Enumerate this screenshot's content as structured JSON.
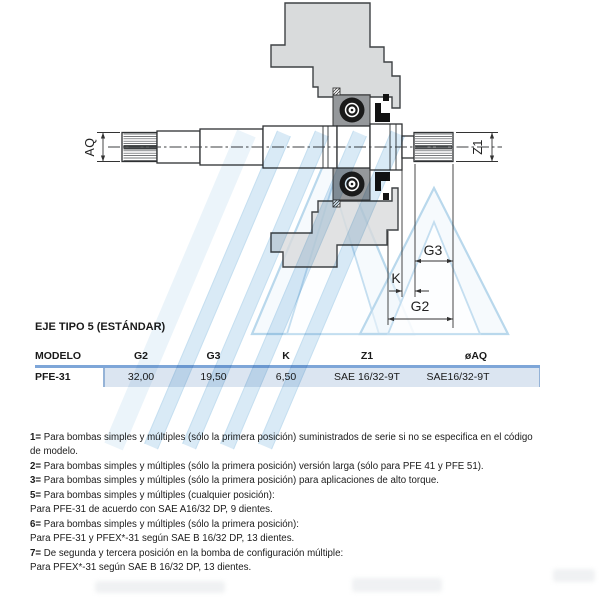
{
  "drawing": {
    "labels": {
      "aq": "AQ",
      "z1": "Z1",
      "g3": "G3",
      "k": "K",
      "g2": "G2"
    }
  },
  "table": {
    "title": "EJE TIPO 5 (ESTÁNDAR)",
    "headers": [
      "MODELO",
      "G2",
      "G3",
      "K",
      "Z1",
      "øAQ"
    ],
    "row": {
      "modelo": "PFE-31",
      "g2": "32,00",
      "g3": "19,50",
      "k": "6,50",
      "z1": "SAE 16/32-9T",
      "aq": "SAE16/32-9T"
    },
    "accent_color": "#7ea6d8",
    "row_bg": "#dbe5f1"
  },
  "footnotes": {
    "lines": [
      {
        "b": "1=",
        "t": " Para bombas simples y múltiples (sólo la primera posición) suministrados de serie si no se especifica en el código"
      },
      {
        "b": "",
        "t": "de modelo."
      },
      {
        "b": "2=",
        "t": " Para bombas simples y múltiples (sólo la primera posición) versión larga (sólo para PFE 41 y PFE 51)."
      },
      {
        "b": "3=",
        "t": " Para bombas simples y múltiples (sólo la primera posición) para aplicaciones de alto torque."
      },
      {
        "b": "5=",
        "t": " Para bombas simples y múltiples (cualquier posición):"
      },
      {
        "b": "",
        "t": "Para PFE-31 de acuerdo con SAE A16/32 DP, 9 dientes."
      },
      {
        "b": "6=",
        "t": " Para bombas simples y múltiples (sólo la primera posición):"
      },
      {
        "b": "",
        "t": "Para PFE-31 y PFEX*-31 según SAE B 16/32 DP, 13 dientes."
      },
      {
        "b": "7=",
        "t": " De segunda y tercera posición en la bomba de configuración múltiple:"
      },
      {
        "b": "",
        "t": "Para PFEX*-31 según SAE B 16/32 DP, 13 dientes."
      }
    ]
  },
  "watermark_color": "#d3e7f5"
}
